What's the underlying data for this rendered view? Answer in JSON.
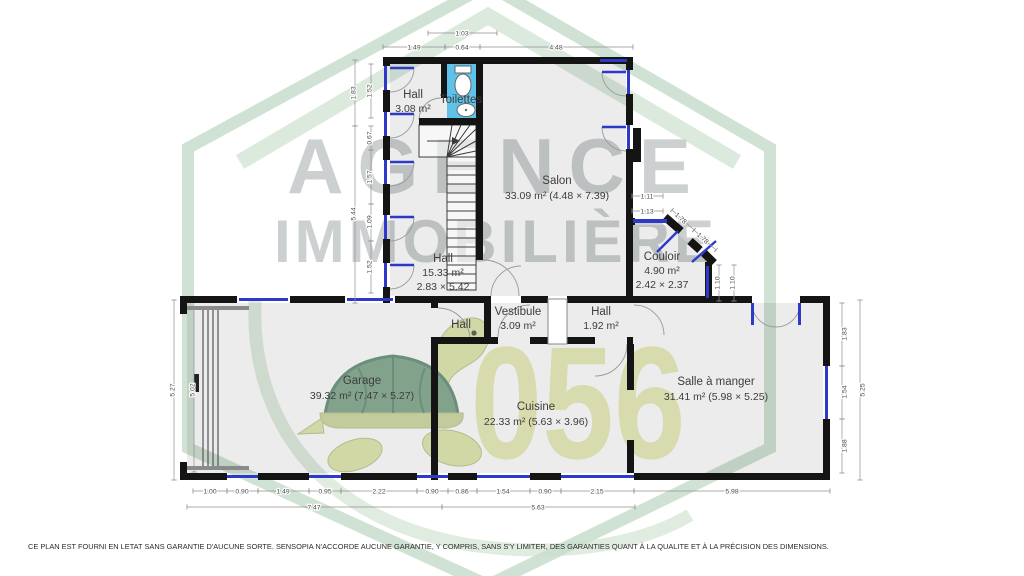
{
  "plan": {
    "rooms": {
      "hall_top": {
        "name": "Hall",
        "area": "3.08 m²"
      },
      "toilettes": {
        "name": "Toilettes"
      },
      "salon": {
        "name": "Salon",
        "area": "33.09 m² (4.48 × 7.39)"
      },
      "hall_mid": {
        "name": "Hall",
        "area": "15.33 m²",
        "size": "2.83 × 5.42"
      },
      "couloir": {
        "name": "Couloir",
        "area": "4.90 m²",
        "size": "2.42 × 2.37"
      },
      "hall_small": {
        "name": "Hall"
      },
      "vestibule": {
        "name": "Vestibule",
        "area": "3.09 m²"
      },
      "hall_back": {
        "name": "Hall",
        "area": "1.92 m²"
      },
      "garage": {
        "name": "Garage",
        "area": "39.32 m² (7.47 × 5.27)"
      },
      "cuisine": {
        "name": "Cuisine",
        "area": "22.33 m² (5.63 × 3.96)"
      },
      "salle_a_manger": {
        "name": "Salle à manger",
        "area": "31.41 m² (5.98 × 5.25)"
      }
    },
    "dims": {
      "top": [
        "1.03",
        "1.49",
        "0.64",
        "4.48"
      ],
      "left_upper_outer": [
        "1.83",
        "5.44"
      ],
      "left_upper_inner": [
        "1.52",
        "0.67",
        "1.57",
        "1.09",
        "1.52"
      ],
      "couloir_h": [
        "1.11",
        "1.13"
      ],
      "couloir_diag": [
        "1.78",
        "1.78"
      ],
      "couloir_v": [
        "1.10",
        "1.10"
      ],
      "left_lower": [
        "5.27",
        "5.02"
      ],
      "right_lower": [
        "1.83",
        "1.54",
        "1.88",
        "5.25"
      ],
      "bottom_inner": [
        "1.00",
        "0.90",
        "1.49",
        "0.95",
        "2.22",
        "0.90",
        "0.86",
        "1.54",
        "0.90",
        "2.15",
        "5.98"
      ],
      "bottom_outer": [
        "7.47",
        "5.63"
      ]
    }
  },
  "watermark": {
    "brand_line1": "AGENCE",
    "brand_line2": "IMMOBILIÈRE",
    "number": "056"
  },
  "footer": {
    "disclaimer": "CE PLAN EST FOURNI EN LETAT SANS GARANTIE D'AUCUNE SORTE. SENSOPIA N'ACCORDE AUCUNE GARANTIE, Y COMPRIS, SANS S'Y LIMITER, DES GARANTIES QUANT À LA QUALITE ET À LA PRÉCISION DES DIMENSIONS."
  },
  "colors": {
    "wall": "#141414",
    "window": "#2f39c9",
    "wet_room": "#5fc2e9",
    "watermark_green": "#bcd6c2",
    "watermark_text": "#c7cbcc",
    "watermark_number": "#e8ecb4"
  }
}
